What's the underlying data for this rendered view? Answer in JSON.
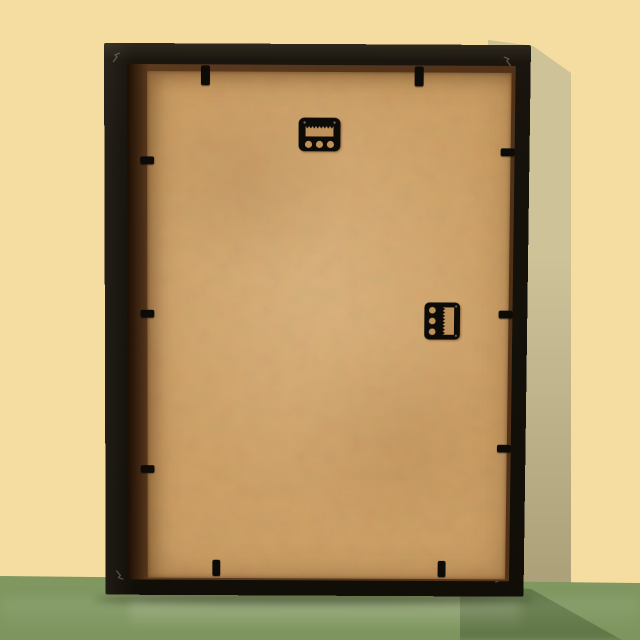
{
  "scene": {
    "description": "Photograph of the back of an empty black picture frame standing upright on a green table against a pale yellow wall, soft shadow falling to the right",
    "object": "picture frame (rear view)",
    "orientation": "portrait"
  },
  "colors": {
    "wall": "#f5dda2",
    "wallShadowTop": "#cdc298",
    "wallShadowBottom": "#a69b74",
    "floorTop": "#98ac76",
    "floorBottom": "#7e955f",
    "frameBlack": "#15110b",
    "frameSheen": "#2e281e",
    "recessDark": "#1d0e03",
    "recessBrown": "#5c3a1e",
    "board": "#cfa166",
    "boardLight": "#d8ab72",
    "boardEdge": "#a87c46",
    "hardwareBlack": "#0d0b07",
    "holeTan": "#c0925a",
    "glint": "#8a8275"
  },
  "hardware": {
    "top_hanger": "sawtooth hanger, portrait position (top center)",
    "side_hanger": "sawtooth hanger, landscape position (right middle)",
    "retaining_clip_count": 10,
    "backing_material": "MDF hardboard"
  }
}
